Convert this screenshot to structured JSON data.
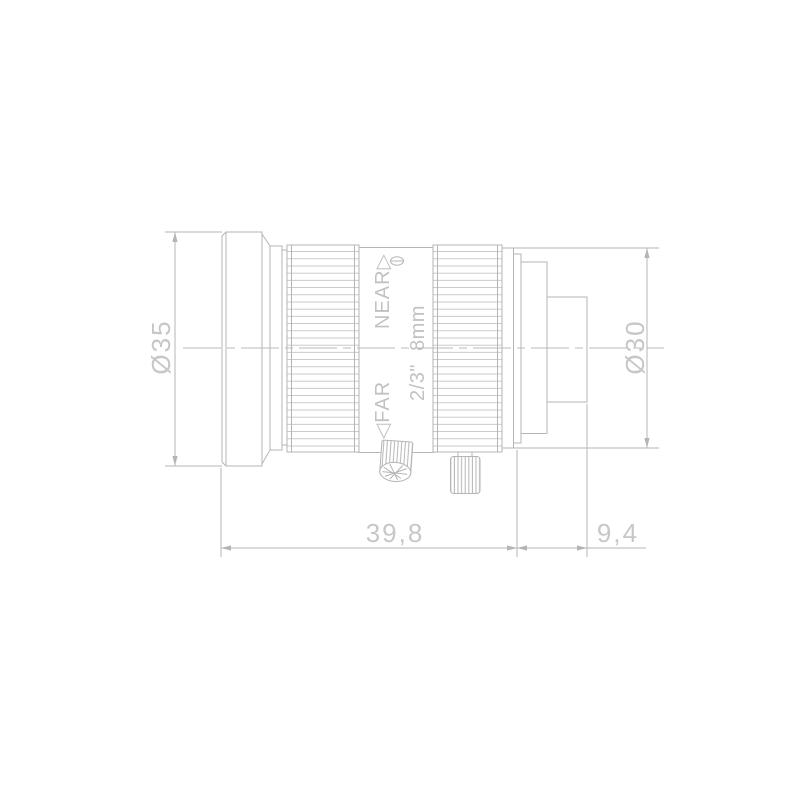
{
  "drawing": {
    "description": "Technical side-view drawing of a C-mount machine vision lens with knurled focus and iris rings, lock thumbscrews and dimension annotations",
    "colors": {
      "background": "#ffffff",
      "line": "#b5b5b5",
      "text": "#c7c7c7"
    },
    "labels": {
      "front_diameter": "Ø35",
      "rear_diameter": "Ø30",
      "body_length": "39,8",
      "rear_length": "9,4",
      "focus_near": "NEAR▷",
      "focus_far": "◁FAR",
      "format_focal": "2/3\" 8mm"
    }
  }
}
